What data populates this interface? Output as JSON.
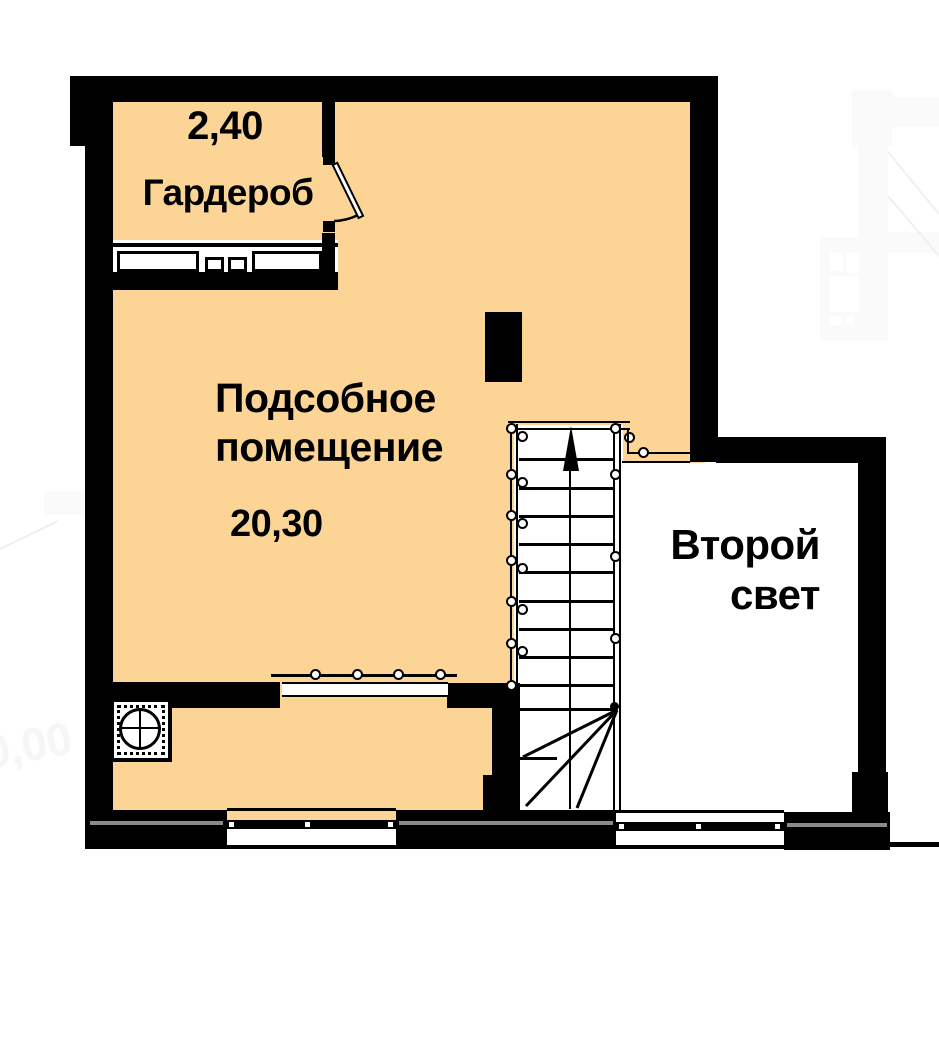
{
  "plan": {
    "type": "floor-plan",
    "rooms": [
      {
        "id": "wardrobe",
        "name": "Гардероб",
        "area": "2,40"
      },
      {
        "id": "utility",
        "name": "Подсобное помещение",
        "area": "20,30"
      },
      {
        "id": "second-light",
        "name": "Второй свет"
      }
    ],
    "stairs": {
      "direction": "up",
      "flight_treads": 10,
      "winder_treads": 3
    },
    "ghost_background": {
      "elevation_mark": "0,00"
    },
    "colors": {
      "floor_fill": "#FCD596",
      "wall": "#000000",
      "window_sill": "#8A8A8A",
      "ghost": "#FAFAFA"
    }
  }
}
